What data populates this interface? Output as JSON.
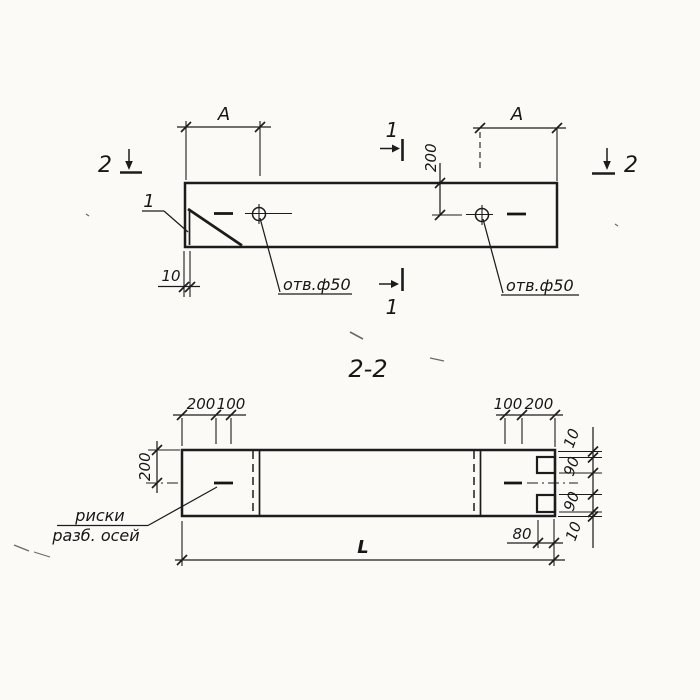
{
  "colors": {
    "ink": "#1c1c1c",
    "paper": "#fbfaf7"
  },
  "plan": {
    "dim_a_left": "A",
    "dim_a_right": "A",
    "dim_hole_offset": "200",
    "dim_edge_offset": "10",
    "hole_label_left": "отв.ф50",
    "hole_label_right": "отв.ф50",
    "marker_1_top": "1",
    "marker_1_bottom": "1",
    "marker_2_left": "2",
    "marker_2_right": "2",
    "detail_callout": "1"
  },
  "section": {
    "title": "2-2",
    "dims_top_left": [
      "200",
      "100"
    ],
    "dims_top_right": [
      "100",
      "200"
    ],
    "dim_height": "200",
    "dims_right": [
      "10",
      "90",
      "90",
      "10"
    ],
    "dim_notch": "80",
    "dim_length": "L",
    "axis_note_line1": "риски",
    "axis_note_line2": "разб. осей"
  }
}
